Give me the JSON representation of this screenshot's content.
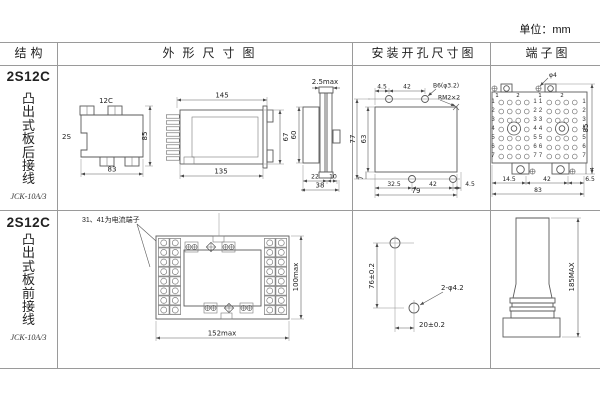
{
  "unit_label": "单位：mm",
  "headers": {
    "structure": "结构",
    "outline": "外形尺寸图",
    "mounting": "安装开孔尺寸图",
    "terminal": "端子图"
  },
  "rows": [
    {
      "model": "2S12C",
      "mount_style": "凸出式板后接线",
      "type_code": "JCK-10A/3",
      "outline": {
        "top_view": {
          "top_label": "12C",
          "left_label": "2S",
          "width": "83",
          "height": "85"
        },
        "side_view": {
          "top_width": "145",
          "bottom_width": "135",
          "height": "67"
        },
        "end_view": {
          "plate": "2.5max",
          "height": "60",
          "d1": "22",
          "d2": "10",
          "total": "38"
        }
      },
      "mounting": {
        "d_top1": "4.5",
        "d_top2": "42",
        "hole_spec": "B6(φ3.2)",
        "screw_spec": "RM2×2",
        "h_outer": "77",
        "h_inner": "63",
        "d_b0": "7",
        "d_b1": "32.5",
        "d_b2": "42",
        "d_b3": "4.5",
        "w_total": "79"
      },
      "terminal": {
        "hole_spec": "φ4",
        "height": "85",
        "d_b1": "14.5",
        "d_b2": "42",
        "d_b3": "6.5",
        "w_total": "83",
        "d_side": "4",
        "top_nums": [
          "1",
          "2",
          "1",
          "2"
        ],
        "left_nums": "1\n2\n3\n4\n5\n6\n7",
        "mid_nums_a": "1\n2\n3\n4\n5\n6\n7",
        "mid_nums_b": "1\n2\n3\n4\n5\n6\n7",
        "right_nums": "1\n2\n3\n4\n5\n6\n7"
      }
    },
    {
      "model": "2S12C",
      "mount_style": "凸出式板前接线",
      "type_code": "JCK-10A/3",
      "note": "31、41为电流端子",
      "outline": {
        "width": "152max",
        "height": "100max"
      },
      "mounting": {
        "v": "76±0.2",
        "h": "20±0.2",
        "hole_spec": "2-φ4.2"
      },
      "terminal": {
        "height": "185MAX"
      }
    }
  ]
}
